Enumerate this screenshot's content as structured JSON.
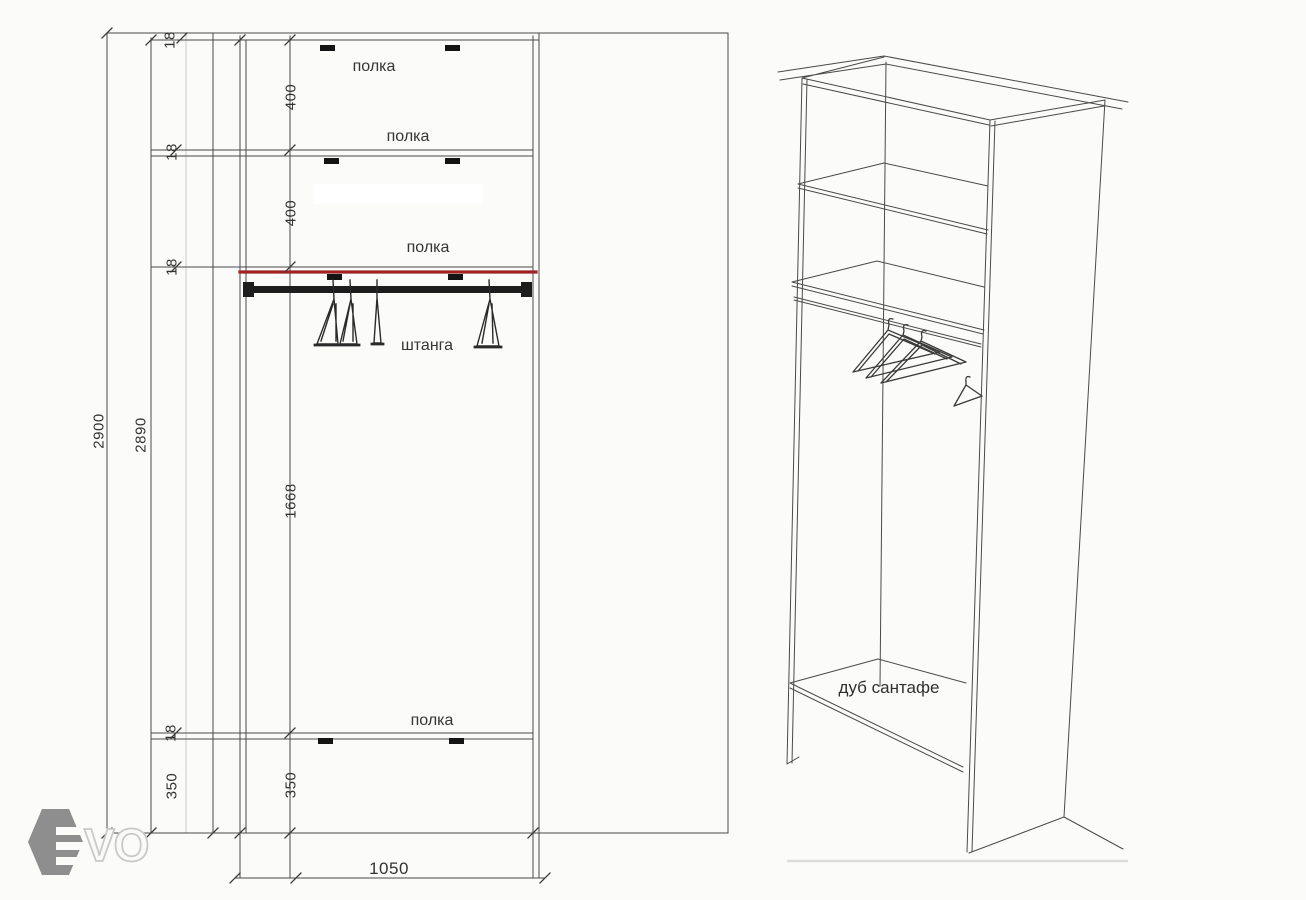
{
  "front_view": {
    "dimensions": {
      "total_height": "2900",
      "inner_height": "2890",
      "panel_thickness": "18",
      "shelf_gap_top": "400",
      "shelf_gap_middle": "400",
      "hanging_height": "1668",
      "plinth_left": "350",
      "plinth_inner": "350",
      "width": "1050"
    },
    "labels": {
      "shelf_top": "полка",
      "shelf_upper": "полка",
      "shelf_middle": "полка",
      "shelf_bottom": "полка",
      "rod": "штанга"
    }
  },
  "perspective_view": {
    "material": "дуб сантафе"
  },
  "logo": {
    "text": "VO"
  },
  "colors": {
    "highlight": "#a02323",
    "ink": "#4a4a4a",
    "logo": "#8e8e8e"
  }
}
